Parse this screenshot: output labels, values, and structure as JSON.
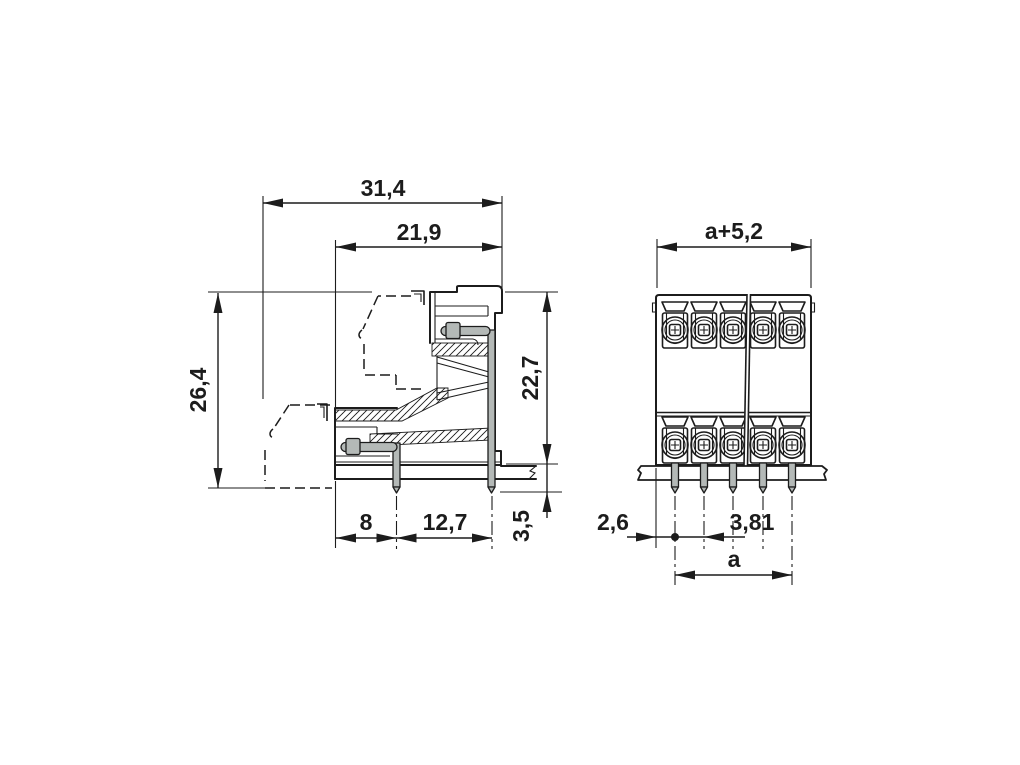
{
  "colors": {
    "line": "#1c1c1c",
    "pin_fill": "#b4b9b7",
    "background": "#ffffff"
  },
  "side_view": {
    "dims": {
      "overall_depth": "31,4",
      "housing_depth": "21,9",
      "overall_height": "26,4",
      "height_above_board": "22,7",
      "pin_below_board": "3,5",
      "pin_setback": "8",
      "row_pitch": "12,7"
    }
  },
  "front_view": {
    "dims": {
      "overall_width": "a+5,2",
      "edge_to_first_pin": "2,6",
      "pin_pitch": "3,81",
      "first_to_last_pin": "a"
    },
    "visible_positions_per_row": 5,
    "rows": 2
  }
}
